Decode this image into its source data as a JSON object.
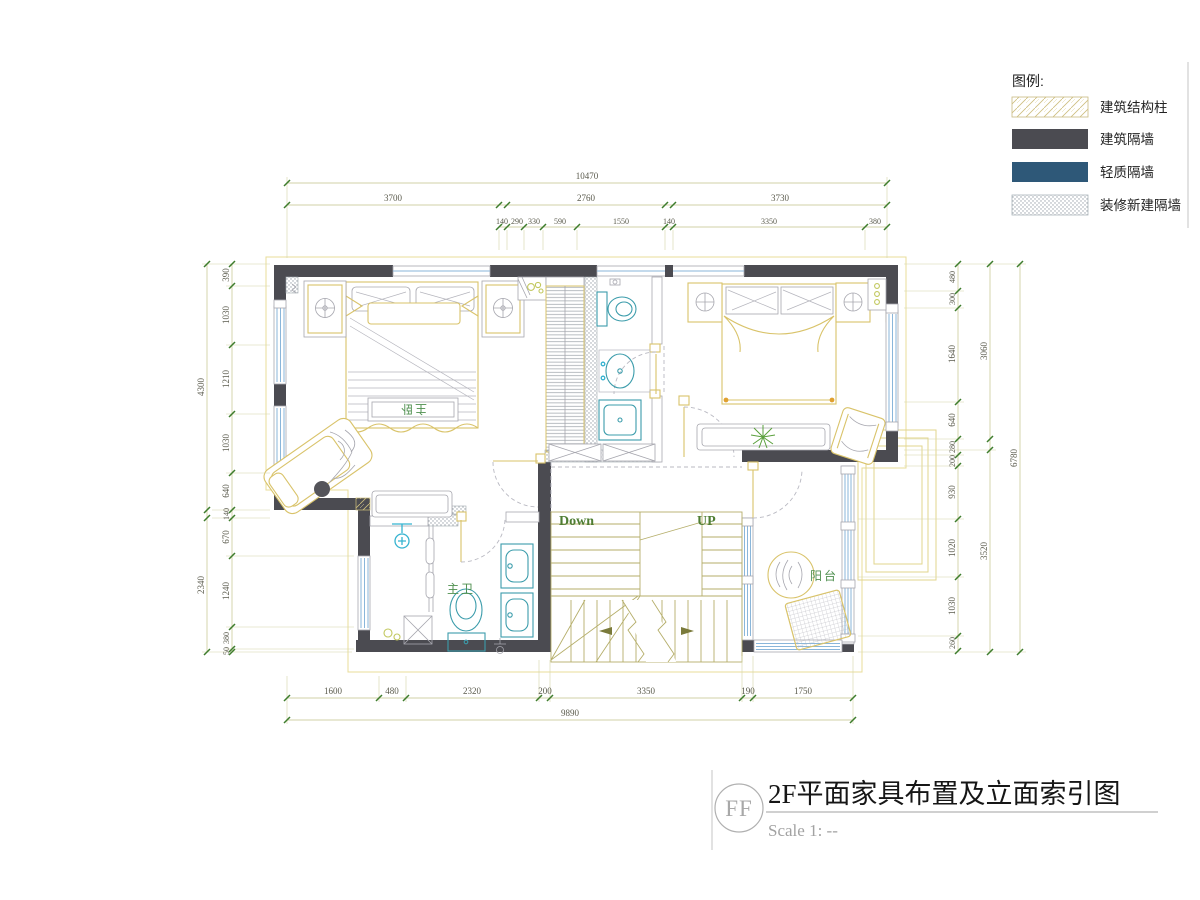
{
  "legend": {
    "title": "图例:",
    "items": [
      {
        "label": "建筑结构柱",
        "type": "hatch"
      },
      {
        "label": "建筑隔墙",
        "type": "solid",
        "color": "#4b4b51"
      },
      {
        "label": "轻质隔墙",
        "type": "solid",
        "color": "#2e5878"
      },
      {
        "label": "装修新建隔墙",
        "type": "dots"
      }
    ]
  },
  "rooms": {
    "master_bedroom": "主卧",
    "master_bathroom": "主卫",
    "balcony": "阳台"
  },
  "stairs": {
    "down": "Down",
    "up": "UP"
  },
  "title_block": {
    "symbol": "FF",
    "title": "2F平面家具布置及立面索引图",
    "scale": "Scale 1: --"
  },
  "dimensions": {
    "top": {
      "total": "10470",
      "row2": [
        "3700",
        "2760",
        "3730"
      ],
      "row3": [
        "140",
        "290",
        "330",
        "590",
        "1550",
        "140",
        "3350",
        "380"
      ]
    },
    "bottom": {
      "segments": [
        "1600",
        "480",
        "2320",
        "200",
        "3350",
        "190",
        "1750"
      ],
      "total": "9890"
    },
    "left": {
      "outer": [
        "4300",
        "2340"
      ],
      "inner": [
        "390",
        "1030",
        "1210",
        "1030",
        "640",
        "140",
        "670",
        "1240",
        "380",
        "50"
      ]
    },
    "right": {
      "inner": [
        "480",
        "300",
        "1640",
        "640",
        "280",
        "200",
        "930",
        "1020",
        "1030",
        "260"
      ],
      "mid": [
        "3060",
        "3520"
      ],
      "outer": "6780"
    }
  }
}
